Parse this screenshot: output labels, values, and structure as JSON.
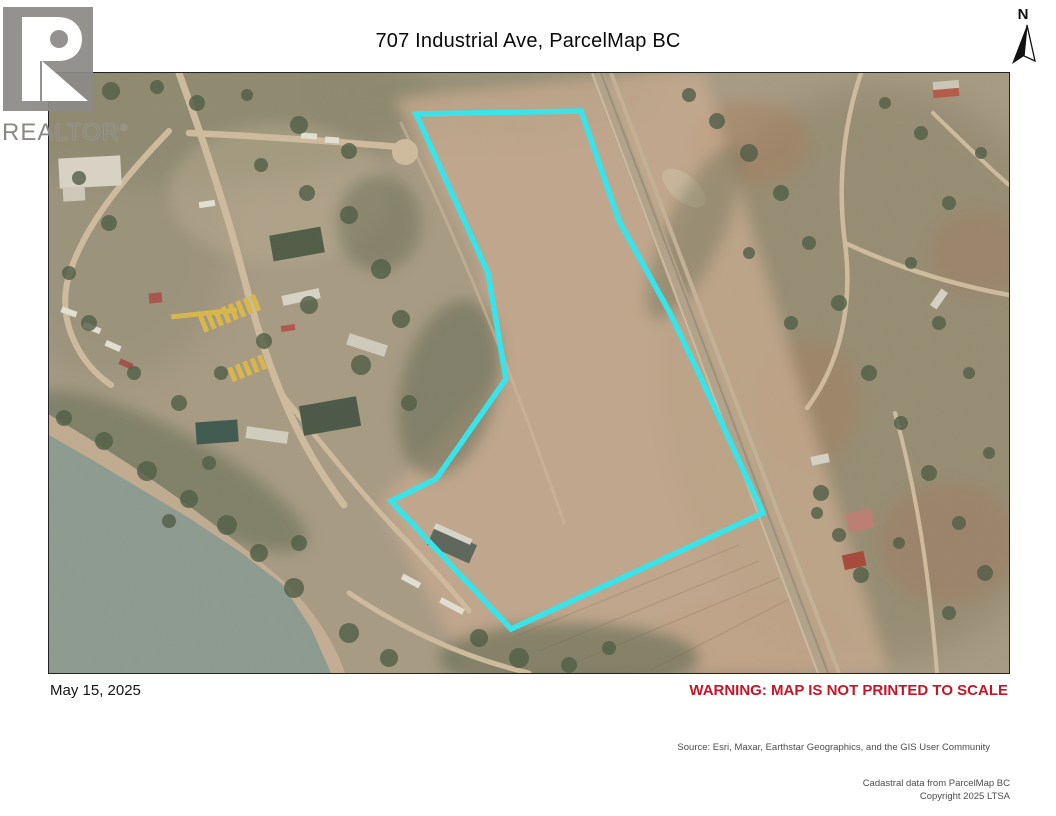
{
  "page": {
    "title": "707 Industrial Ave, ParcelMap BC",
    "date": "May 15, 2025",
    "warning": "WARNING: MAP IS NOT PRINTED TO SCALE",
    "source": "Source: Esri, Maxar, Earthstar Geographics, and the GIS User Community",
    "cadastral_line1": "Cadastral data from ParcelMap BC",
    "cadastral_line2": "Copyright 2025 LTSA"
  },
  "branding": {
    "wordmark": "REALTOR",
    "registered_mark": "®"
  },
  "compass": {
    "label": "N"
  },
  "map": {
    "description": "Aerial satellite imagery with highlighted cadastral parcel boundary",
    "parcel_outline_color": "#38e4e9",
    "warning_color": "#c61528",
    "water_color": "#8c9b90",
    "terrain_color": "#a89b84",
    "parcel_polygon": [
      [
        367,
        41
      ],
      [
        532,
        38
      ],
      [
        570,
        148
      ],
      [
        620,
        238
      ],
      [
        652,
        305
      ],
      [
        714,
        440
      ],
      [
        462,
        556
      ],
      [
        342,
        428
      ],
      [
        387,
        406
      ],
      [
        457,
        306
      ],
      [
        439,
        200
      ]
    ]
  }
}
